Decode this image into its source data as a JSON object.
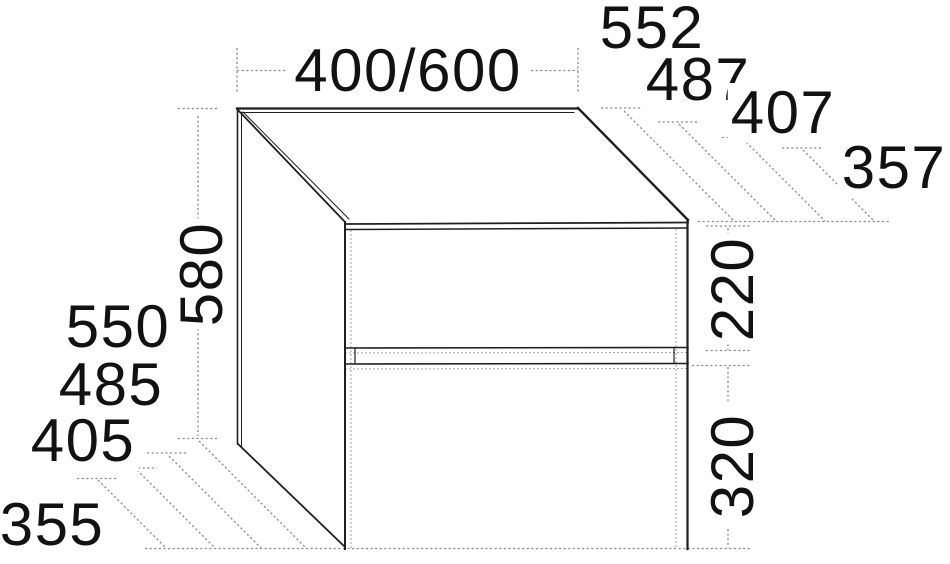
{
  "drawing": {
    "type": "furniture-technical-drawing",
    "unit_style": "two-drawer cabinet, isometric view",
    "width_dim": "400/600",
    "depth_dims": [
      "552",
      "487",
      "407",
      "357"
    ],
    "height_dim": "580",
    "height_variant_dims": [
      "550",
      "485",
      "405",
      "355"
    ],
    "upper_drawer_dim": "220",
    "lower_drawer_dim": "320"
  },
  "colors": {
    "background": "#ffffff",
    "edge_line": "#1f1f1f",
    "dimension_line": "#8c8c8c",
    "hidden_line": "#a9a9a9",
    "text": "#121212"
  }
}
